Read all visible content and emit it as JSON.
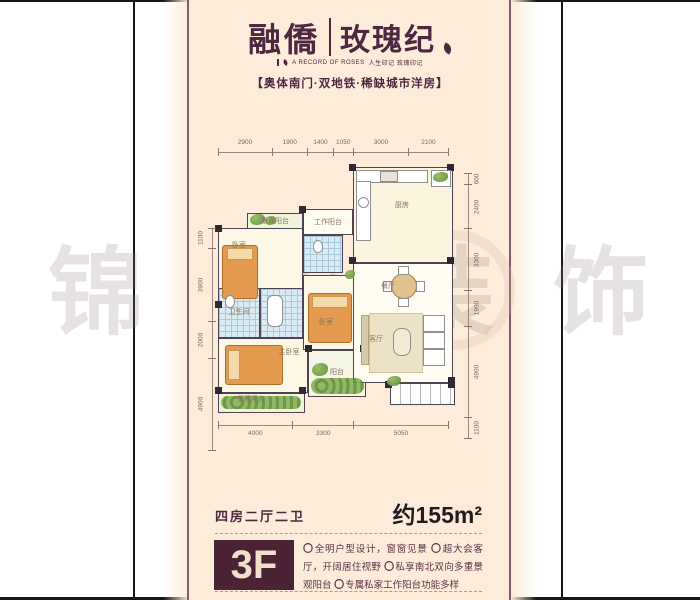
{
  "brand": {
    "name_left": "融僑",
    "name_right": "玫瑰纪",
    "tagline_en": "A RECORD OF ROSES",
    "tagline_cn": "人生印记 玫瑰印记",
    "subtitle": "【奥体南门·双地铁·稀缺城市洋房】"
  },
  "watermark": {
    "chars": [
      "锦",
      "华",
      "装",
      "饰"
    ]
  },
  "floorplan": {
    "dims_top": [
      "2900",
      "1900",
      "1400",
      "1050",
      "3000",
      "2100"
    ],
    "dims_bottom": [
      "4000",
      "3300",
      "5050"
    ],
    "dims_left": [
      "1100",
      "3900",
      "2000",
      "4900"
    ],
    "dims_right": [
      "600",
      "2400",
      "3300",
      "1900",
      "4900",
      "1100"
    ],
    "rooms": [
      {
        "t": "景观阳台",
        "x": 80,
        "y": 96
      },
      {
        "t": "工作阳台",
        "x": 133,
        "y": 97
      },
      {
        "t": "厨房",
        "x": 207,
        "y": 80
      },
      {
        "t": "卧室",
        "x": 44,
        "y": 120
      },
      {
        "t": "卫生间",
        "x": 44,
        "y": 187
      },
      {
        "t": "餐厅",
        "x": 193,
        "y": 161
      },
      {
        "t": "卧室",
        "x": 131,
        "y": 197
      },
      {
        "t": "客厅",
        "x": 181,
        "y": 214
      },
      {
        "t": "主卧室",
        "x": 94,
        "y": 227
      },
      {
        "t": "阳台",
        "x": 142,
        "y": 247
      },
      {
        "t": "景观阳台",
        "x": 56,
        "y": 274
      }
    ]
  },
  "floor_info": {
    "layout": "四房二厅二卫",
    "area": "约155m²",
    "floor": "3F",
    "bullet": "〇",
    "features": [
      "全明户型设计，窗窗见景",
      "超大会客厅，开阔居住视野",
      "私享南北双向多重景观阳台",
      "专属私家工作阳台功能多样"
    ]
  },
  "colors": {
    "maroon": "#4e2741",
    "panel_cream": "#fcecd9",
    "floor_box": "#4b2335",
    "wall": "#4d4352",
    "bed_orange": "#e49a4f",
    "tile_blue": "#d9ebf5",
    "plant_green": "#6f9c46"
  }
}
